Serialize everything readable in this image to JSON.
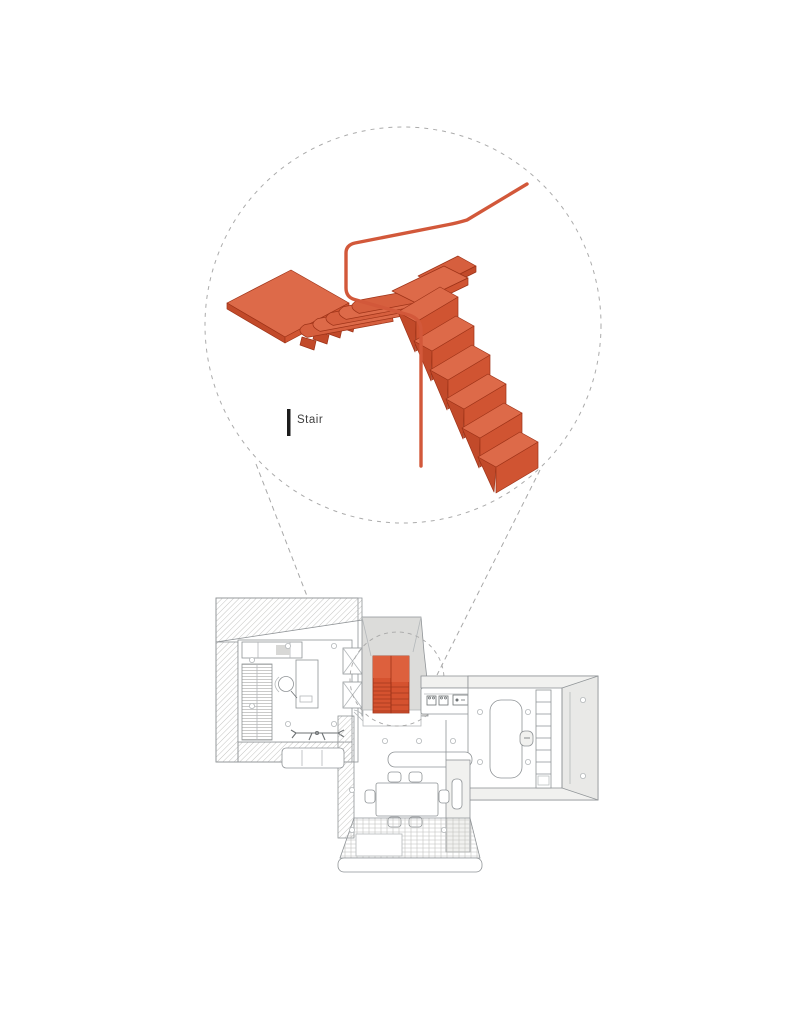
{
  "detail_callout": {
    "label": "Stair"
  },
  "colors": {
    "background": "#ffffff",
    "callout_circle": "#ababab",
    "leader_line": "#a8a8a8",
    "label_text": "#3f3f3f",
    "label_marker": "#1c1c1c",
    "stair_top": "#dd6a49",
    "stair_mid": "#d65f3e",
    "stair_riser": "#d05432",
    "stair_fold": "#c24a2a",
    "stair_outline": "#9e3318",
    "stair_plan_fill": "#d5522f",
    "stair_plan_landing": "#dd603d",
    "stair_plan_line": "#a33a1e",
    "handrail": "#d2583a",
    "plan_line": "#8f9396",
    "plan_line_light": "#b4b8ba",
    "plan_line_dark": "#6d7173",
    "plan_wall_fill": "#f1f1ef",
    "plan_shade": "#dcdcda",
    "plan_slab": "#e9e9e7",
    "plan_item_dark": "#d8d8d6",
    "hatch": "#bdbdbb"
  }
}
